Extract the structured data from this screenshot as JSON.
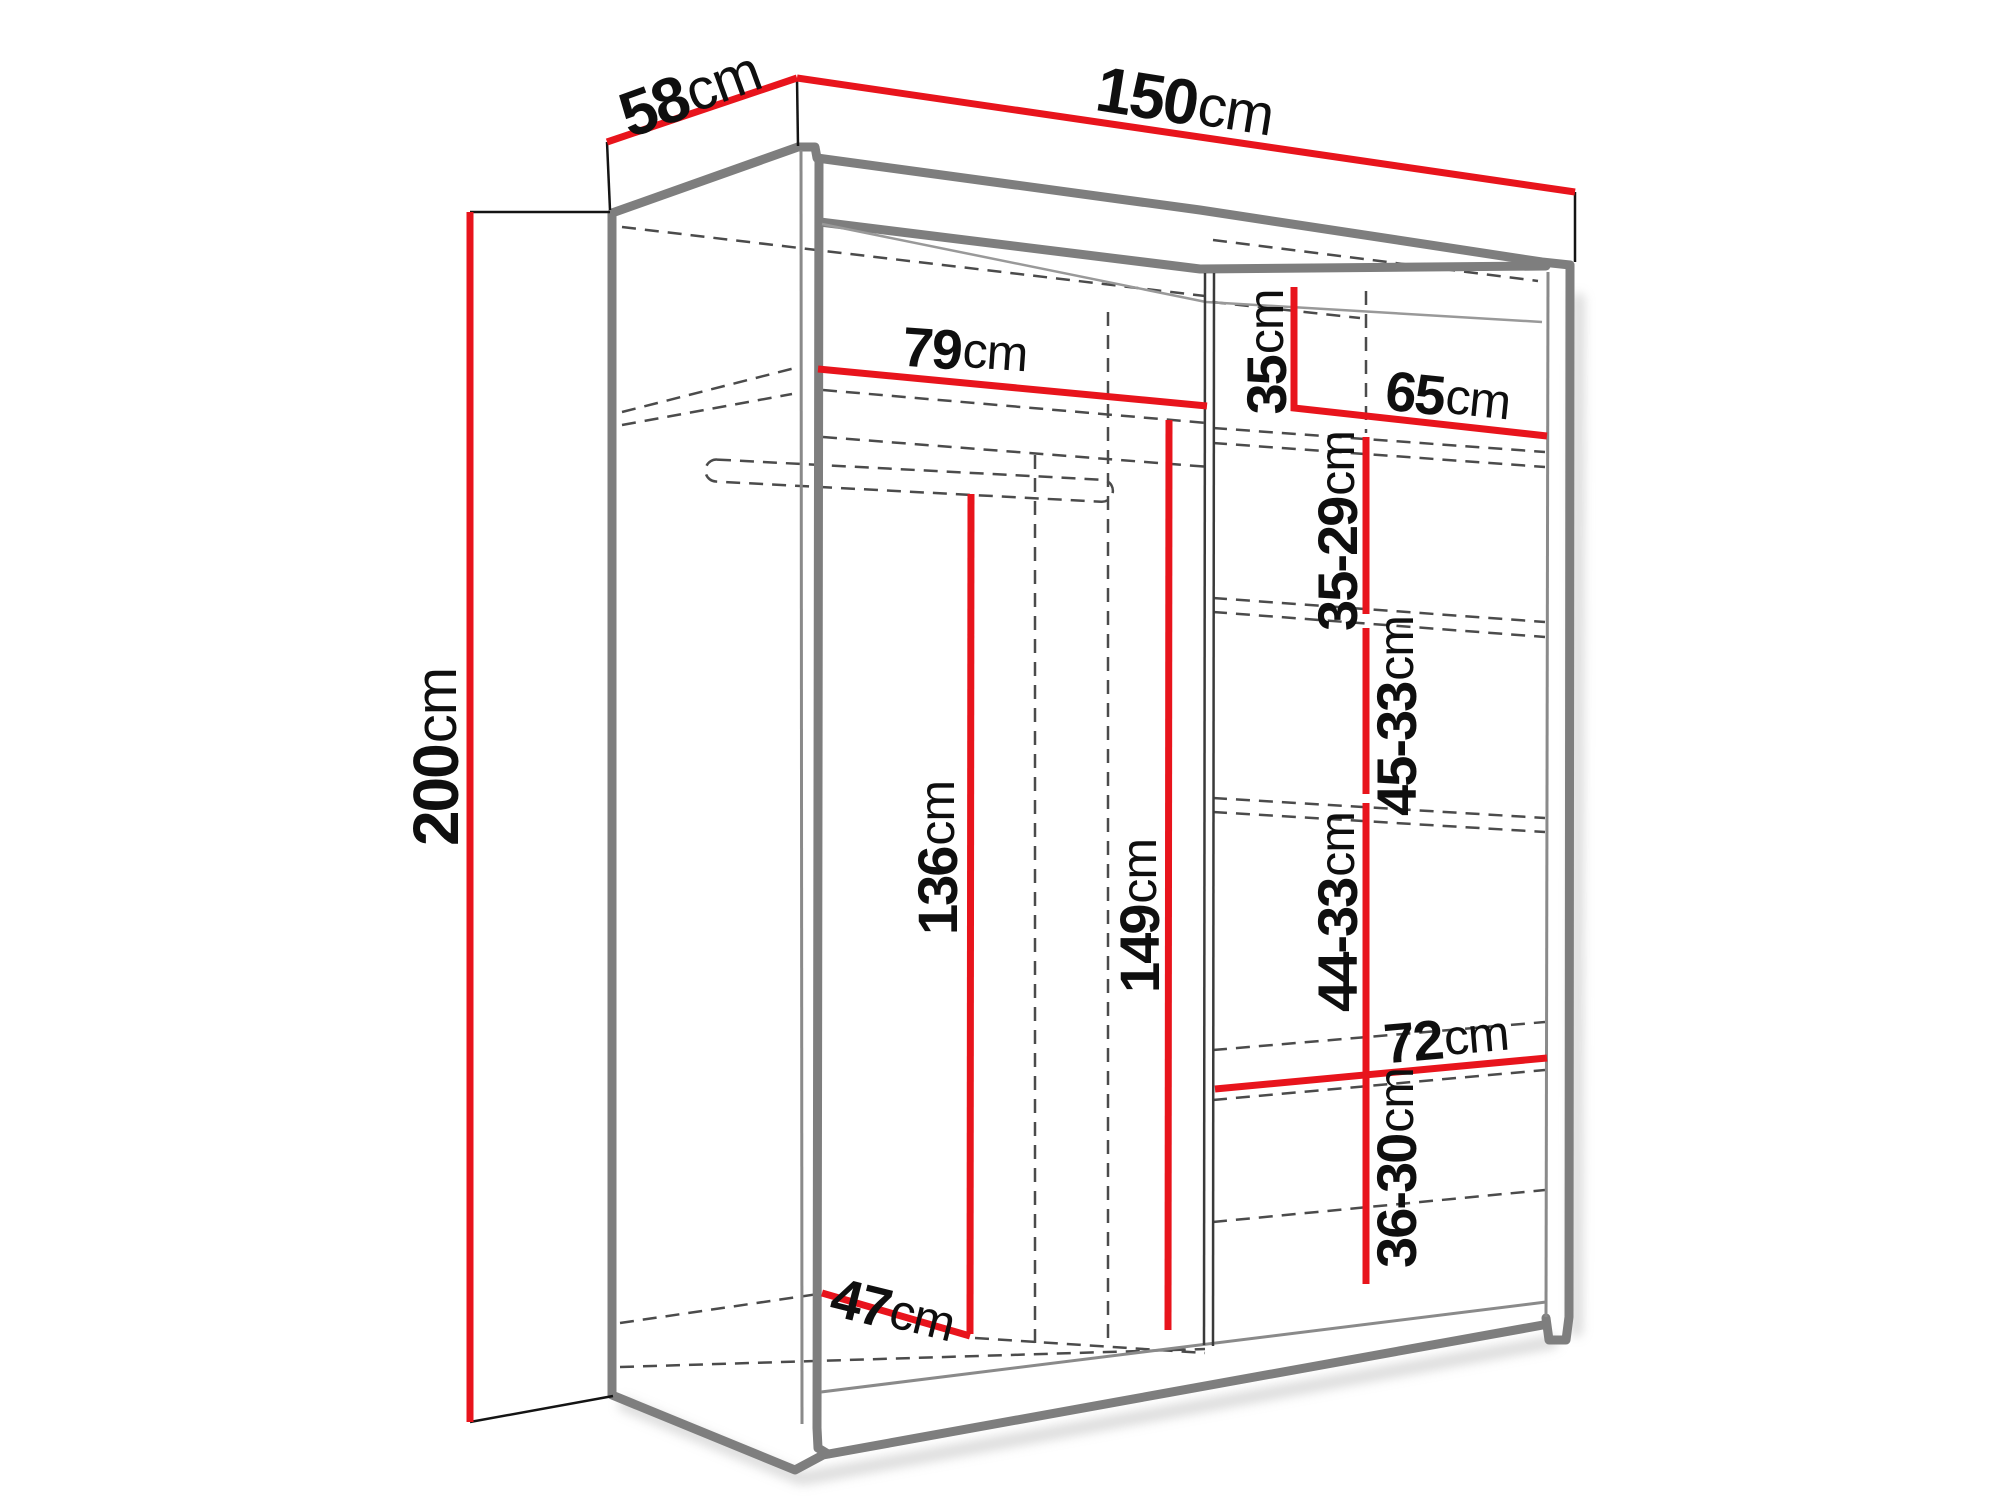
{
  "page": {
    "background": "#ffffff"
  },
  "diagram": {
    "kind": "wardrobe-dimension-diagram",
    "unit": "cm",
    "colors": {
      "dimension_lines": "#e8141c",
      "outlines": "#7e7e7e",
      "labels": "#0f0f0f",
      "dashed_lines": "#4b4b4b",
      "background": "#ffffff"
    },
    "labels": {
      "depth": {
        "num": "58",
        "unit": "cm"
      },
      "width": {
        "num": "150",
        "unit": "cm"
      },
      "height": {
        "num": "200",
        "unit": "cm"
      },
      "left_section_width": {
        "num": "79",
        "unit": "cm"
      },
      "top_shelf_height": {
        "num": "35",
        "unit": "cm"
      },
      "right_section_width": {
        "num": "65",
        "unit": "cm"
      },
      "shelf_gap_1": {
        "num": "35-29",
        "unit": "cm"
      },
      "shelf_gap_2": {
        "num": "45-33",
        "unit": "cm"
      },
      "hanging_height": {
        "num": "136",
        "unit": "cm"
      },
      "center_height": {
        "num": "149",
        "unit": "cm"
      },
      "shelf_gap_3": {
        "num": "44-33",
        "unit": "cm"
      },
      "lower_shelf_width": {
        "num": "72",
        "unit": "cm"
      },
      "bottom_shelf_height": {
        "num": "36-30",
        "unit": "cm"
      },
      "floor_depth": {
        "num": "47",
        "unit": "cm"
      }
    }
  }
}
